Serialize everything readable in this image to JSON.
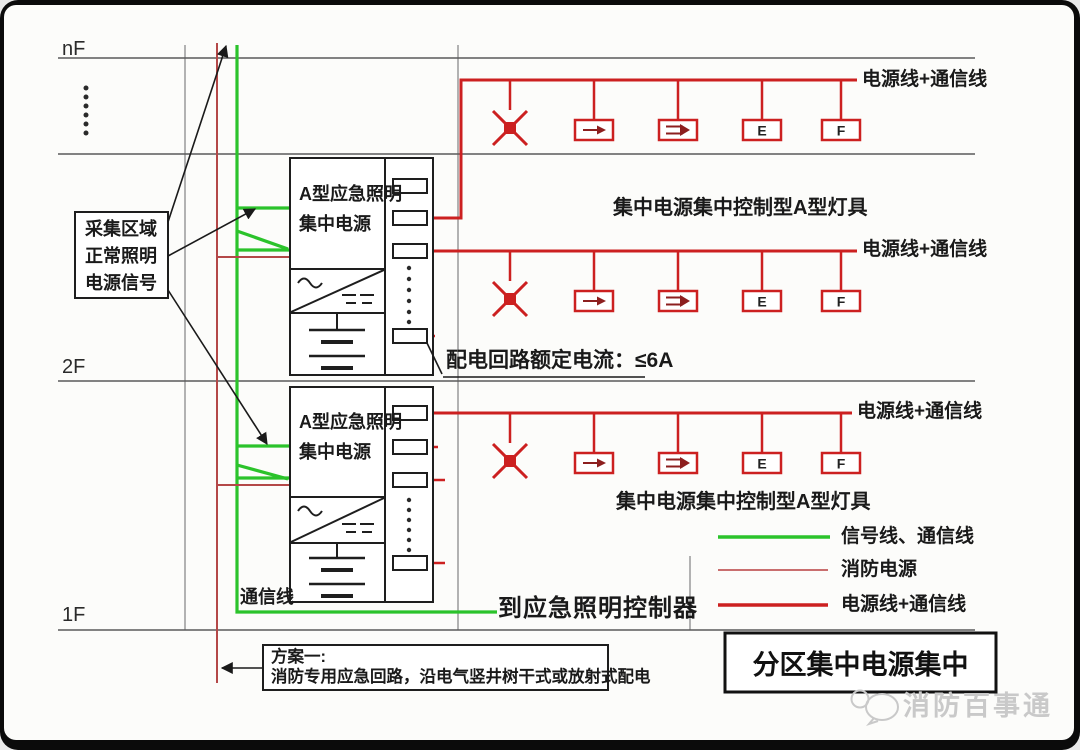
{
  "floors": {
    "top": "nF",
    "second": "2F",
    "first": "1F"
  },
  "collect_signal_box": {
    "line1": "采集区域",
    "line2": "正常照明",
    "line3": "电源信号"
  },
  "power_units": [
    {
      "name_line1": "A型应急照明",
      "name_line2": "集中电源"
    },
    {
      "name_line1": "A型应急照明",
      "name_line2": "集中电源"
    }
  ],
  "circuit_note": "配电回路额定电流：≤6A",
  "comm_line_label": "通信线",
  "to_controller_label": "到应急照明控制器",
  "rows": [
    {
      "wire_label": "电源线+通信线",
      "caption": "集中电源集中控制型A型灯具",
      "lamps": [
        {
          "icon": "ceiling-lamp-x-icon"
        },
        {
          "icon": "exit-arrow-icon"
        },
        {
          "icon": "exit-double-arrow-icon"
        },
        {
          "icon": "letter-lamp",
          "label": "E"
        },
        {
          "icon": "letter-lamp",
          "label": "F"
        }
      ]
    },
    {
      "wire_label": "电源线+通信线",
      "lamps": [
        {
          "icon": "ceiling-lamp-x-icon"
        },
        {
          "icon": "exit-arrow-icon"
        },
        {
          "icon": "exit-double-arrow-icon"
        },
        {
          "icon": "letter-lamp",
          "label": "E"
        },
        {
          "icon": "letter-lamp",
          "label": "F"
        }
      ]
    },
    {
      "wire_label": "电源线+通信线",
      "caption": "集中电源集中控制型A型灯具",
      "lamps": [
        {
          "icon": "ceiling-lamp-x-icon"
        },
        {
          "icon": "exit-arrow-icon"
        },
        {
          "icon": "exit-double-arrow-icon"
        },
        {
          "icon": "letter-lamp",
          "label": "E"
        },
        {
          "icon": "letter-lamp",
          "label": "F"
        }
      ]
    }
  ],
  "legend": {
    "items": [
      {
        "label": "信号线、通信线",
        "color": "#2bc32b",
        "style": "thick"
      },
      {
        "label": "消防电源",
        "color": "#c25a5a",
        "style": "thin"
      },
      {
        "label": "电源线+通信线",
        "color": "#cc2020",
        "style": "thick"
      }
    ]
  },
  "plan_box": {
    "line1": "方案一:",
    "line2": "消防专用应急回路，沿电气竖井树干式或放射式配电"
  },
  "title_box": {
    "text": "分区集中电源集中"
  },
  "watermark": {
    "text": "消防百事通"
  },
  "colors": {
    "signal_green": "#2bc32b",
    "power_red": "#cc2020",
    "fire_power_red": "#b44848",
    "grid_gray": "#9a9a9a",
    "floor_line": "#5a5a5a",
    "ink": "#1a1a1a"
  }
}
